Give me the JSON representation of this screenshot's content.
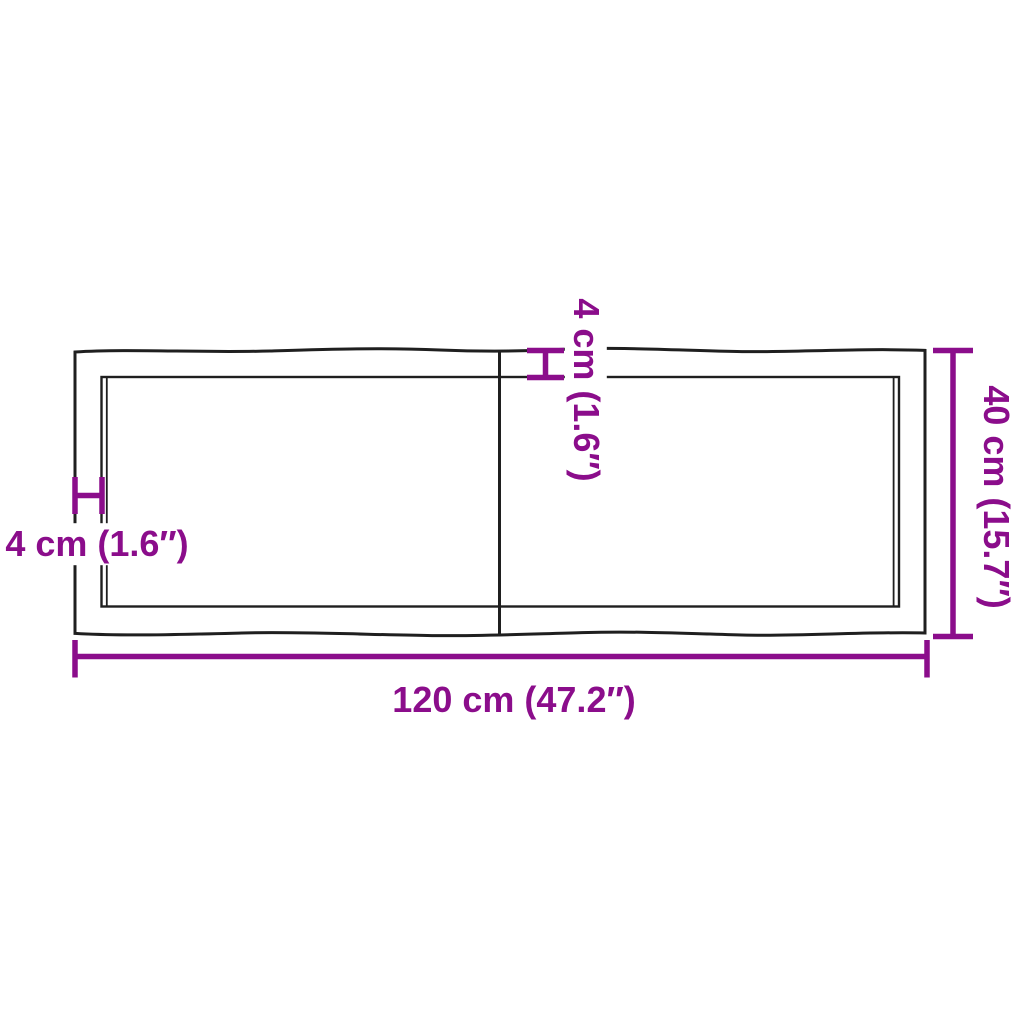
{
  "diagram": {
    "subject": "rectangular table top with live wavy edges and a center seam, shown with dimension lines",
    "colors": {
      "dimension": "#8b0d8b",
      "outline": "#1f1f1f",
      "background": "#ffffff"
    },
    "labels": {
      "width": "120 cm (47.2″)",
      "height": "40 cm (15.7″)",
      "thickness_top": "4 cm (1.6″)",
      "thickness_left": "4 cm (1.6″)"
    },
    "measurements": {
      "width_cm": 120,
      "width_in": 47.2,
      "height_cm": 40,
      "height_in": 15.7,
      "edge_cm": 4,
      "edge_in": 1.6
    }
  }
}
